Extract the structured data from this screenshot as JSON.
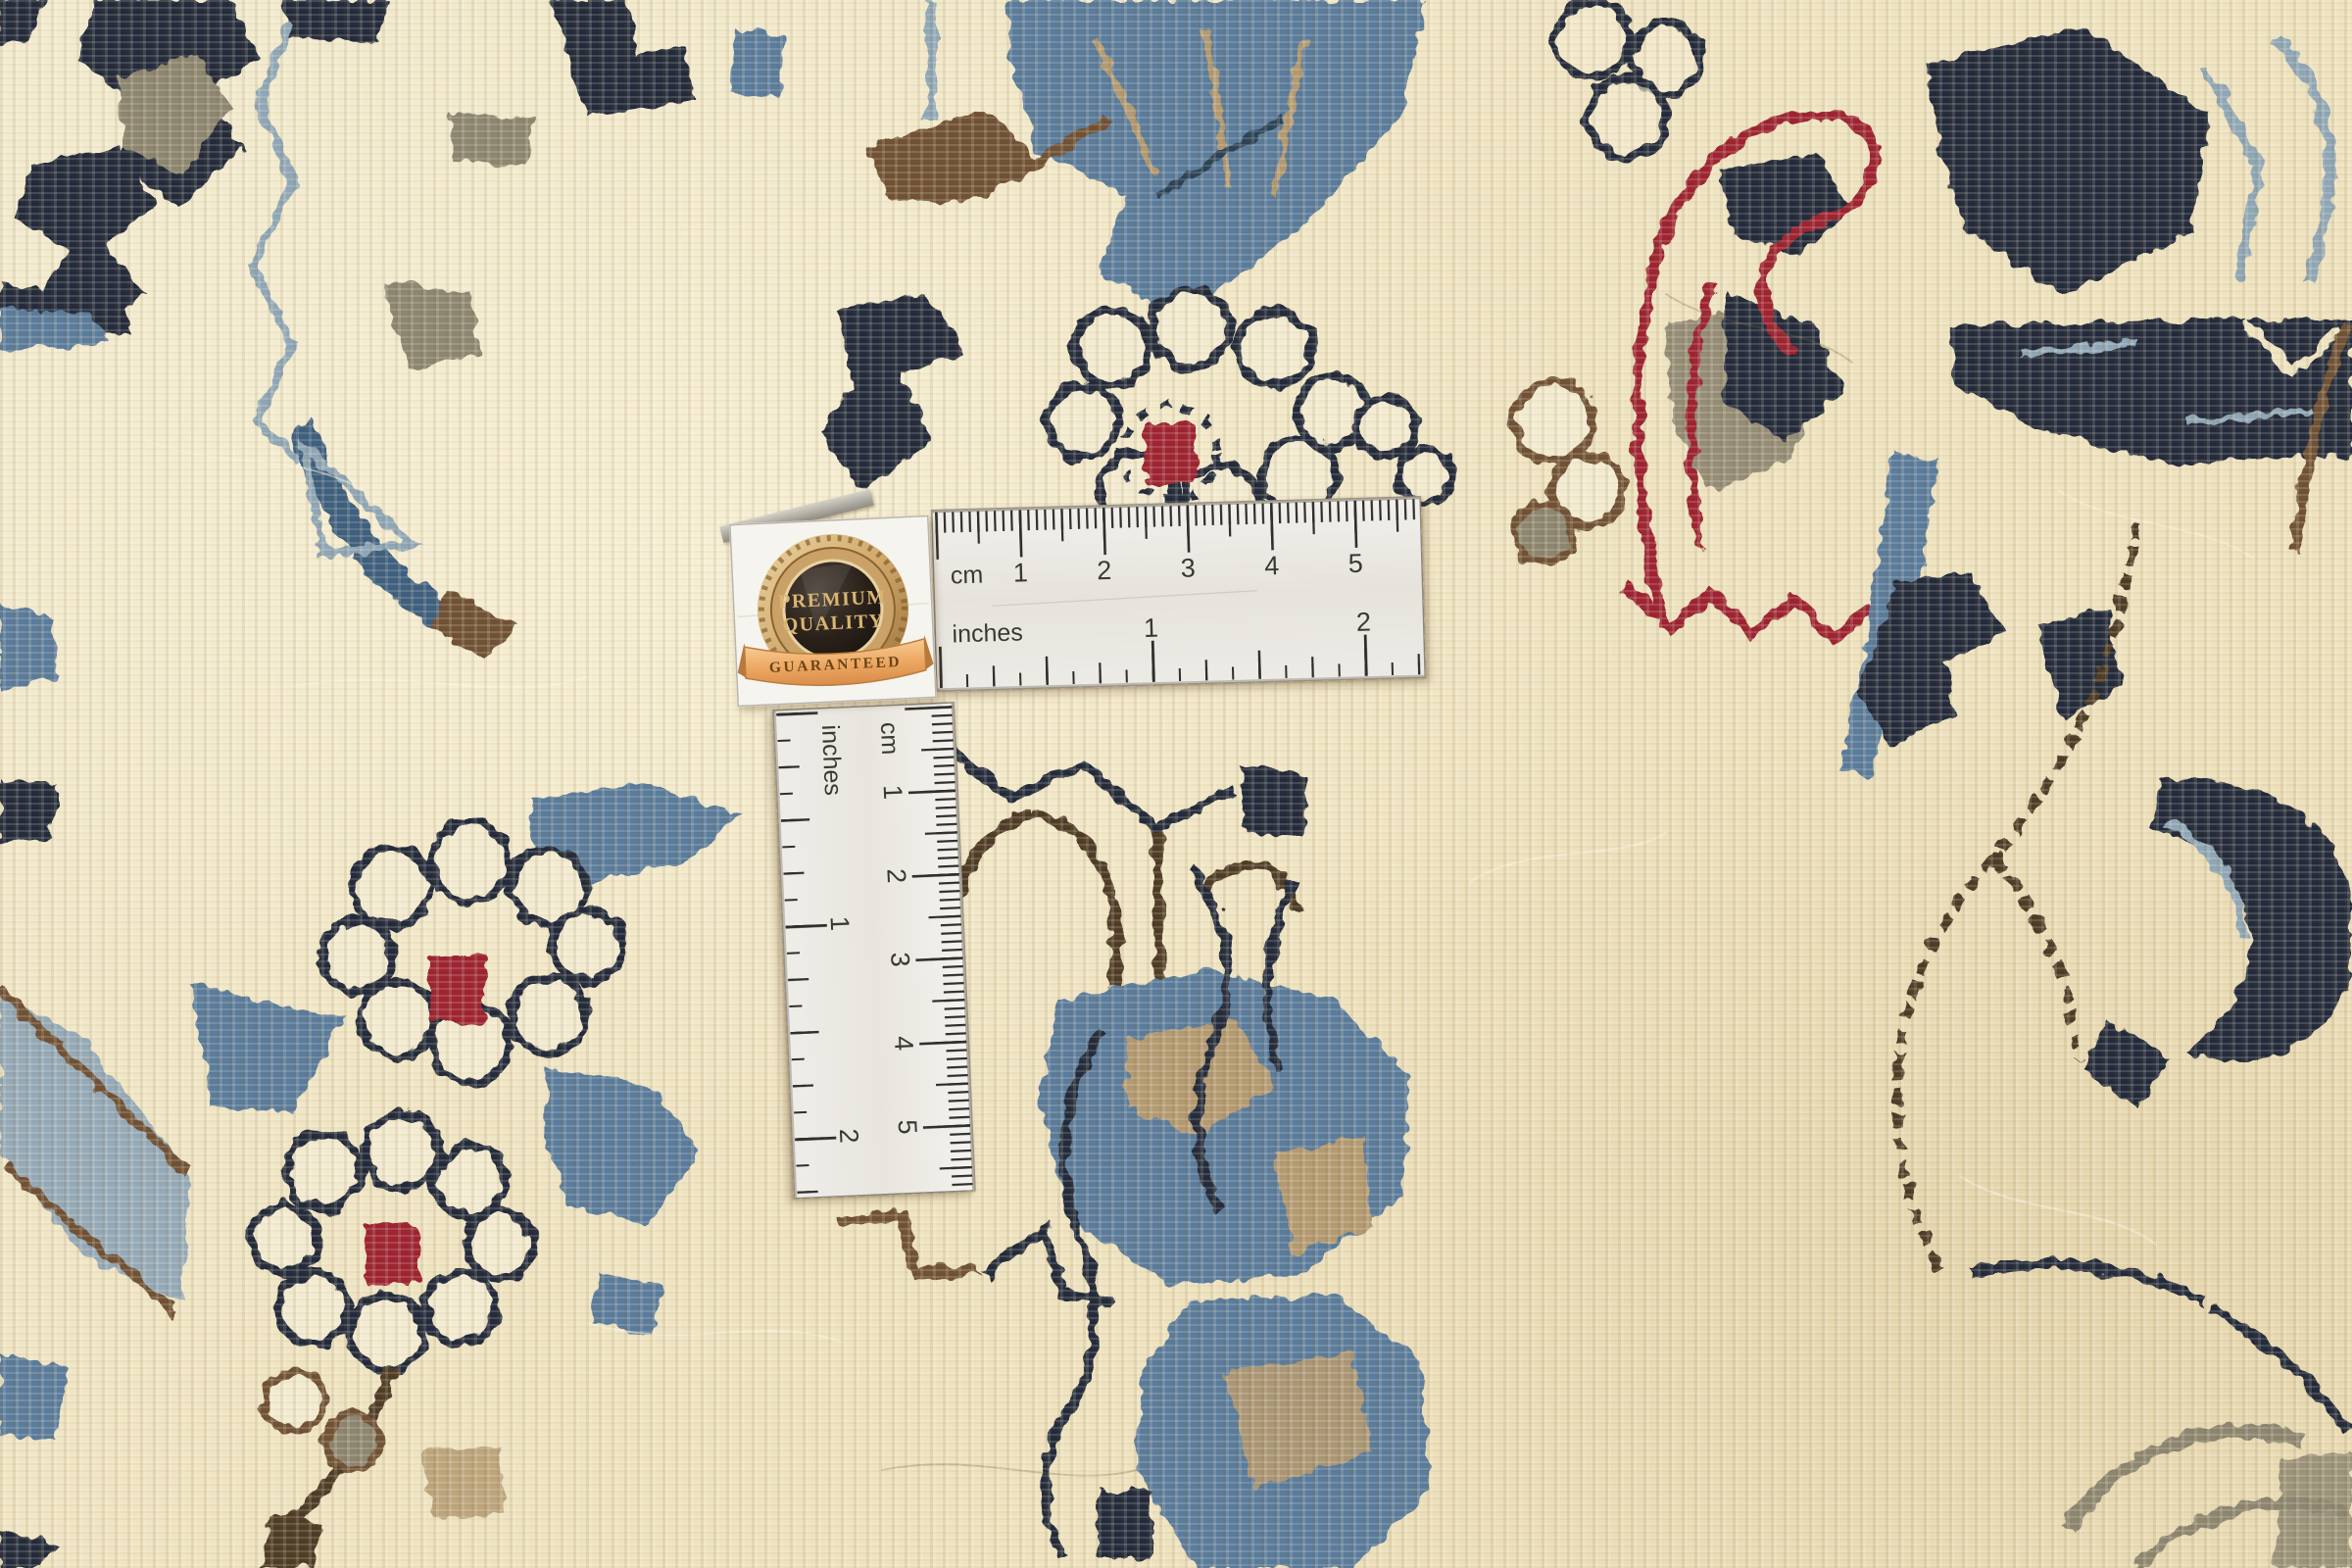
{
  "badge": {
    "title_line1": "PREMIUM",
    "title_line2": "QUALITY",
    "ribbon_text": "GUARANTEED"
  },
  "ruler_horizontal": {
    "unit_primary": "cm",
    "unit_secondary": "inches",
    "cm_labels": [
      "1",
      "2",
      "3",
      "4",
      "5"
    ],
    "inch_labels": [
      "1",
      "2"
    ]
  },
  "ruler_vertical": {
    "unit_primary": "cm",
    "unit_secondary": "inches",
    "cm_labels": [
      "1",
      "2",
      "3",
      "4",
      "5"
    ],
    "inch_labels": [
      "1",
      "2"
    ]
  },
  "palette": {
    "carpet_cream": "#efe4c2",
    "petal_cream": "#f3ebd1",
    "steel_blue": "#5a7c9d",
    "pale_blue": "#8fa7b8",
    "navy": "#222b3a",
    "dark_brown": "#4e3a27",
    "mid_brown": "#6f5136",
    "tan": "#b49a72",
    "taupe": "#8d8671",
    "accent_red": "#9e2330",
    "ruler_white": "#ebe8e3",
    "tick_dark": "#2f2e2c",
    "badge_gold": "#d8b571",
    "ribbon_orange": "#eda963"
  }
}
